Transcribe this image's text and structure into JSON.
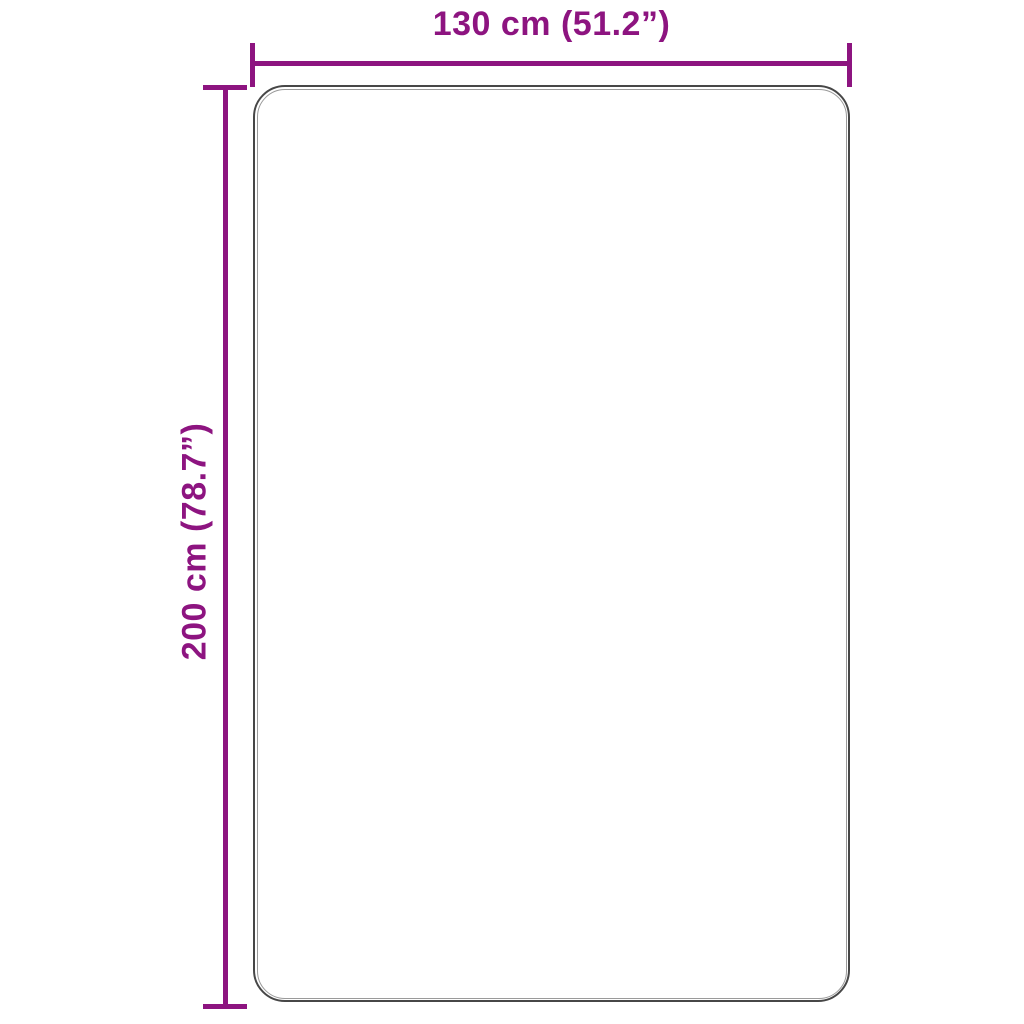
{
  "figure": {
    "type": "product-dimension-diagram",
    "shape": "rounded-rectangle-outline",
    "width_label": "130 cm (51.2”)",
    "height_label": "200 cm (78.7”)"
  },
  "colors": {
    "dimension_accent": "#8d1480",
    "outline_outer": "#474747",
    "outline_inner": "#9a9a9a",
    "background": "#ffffff"
  }
}
